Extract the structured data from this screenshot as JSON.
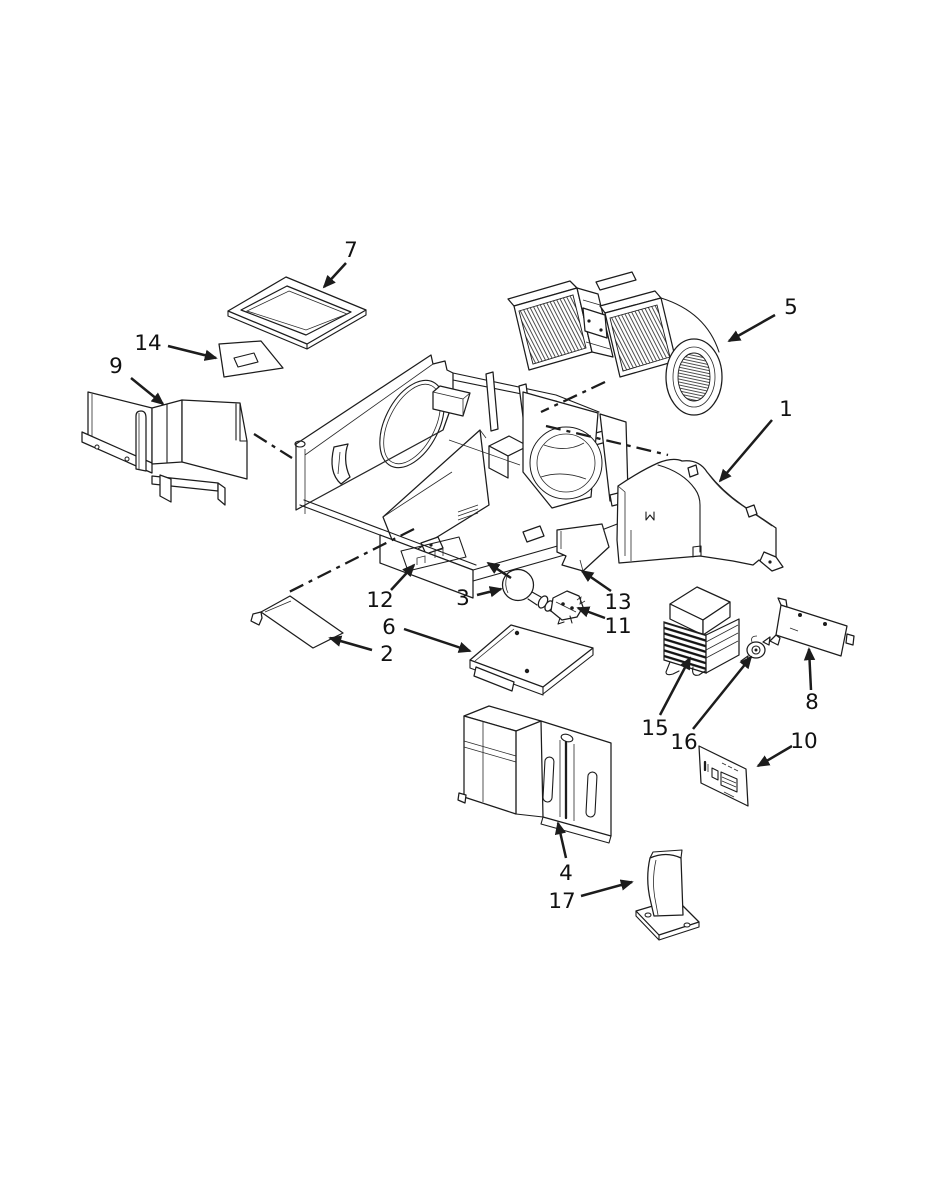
{
  "figure": {
    "type": "exploded-parts-diagram",
    "background": "#ffffff",
    "line_color": "#1c1c1c"
  },
  "callouts": {
    "c1": {
      "label": "1",
      "part": "exhaust-duct"
    },
    "c2": {
      "label": "2",
      "part": "access-cover-plate"
    },
    "c3": {
      "label": "3",
      "part": "light-bulb"
    },
    "c4": {
      "label": "4",
      "part": "air-duct-assembly"
    },
    "c5": {
      "label": "5",
      "part": "blower-assembly"
    },
    "c6": {
      "label": "6",
      "part": "mounting-plate"
    },
    "c7": {
      "label": "7",
      "part": "filter-frame"
    },
    "c8": {
      "label": "8",
      "part": "bracket-plate"
    },
    "c9": {
      "label": "9",
      "part": "air-deflector-assembly"
    },
    "c10": {
      "label": "10",
      "part": "label-plate"
    },
    "c11": {
      "label": "11",
      "part": "bulb-socket"
    },
    "c12": {
      "label": "12",
      "part": "chassis-base-assembly"
    },
    "c13": {
      "label": "13",
      "part": "cavity-cover-plate"
    },
    "c14": {
      "label": "14",
      "part": "wedge-bracket"
    },
    "c15": {
      "label": "15",
      "part": "high-voltage-transformer"
    },
    "c16": {
      "label": "16",
      "part": "thermostat"
    },
    "c17": {
      "label": "17",
      "part": "support-bracket"
    }
  }
}
